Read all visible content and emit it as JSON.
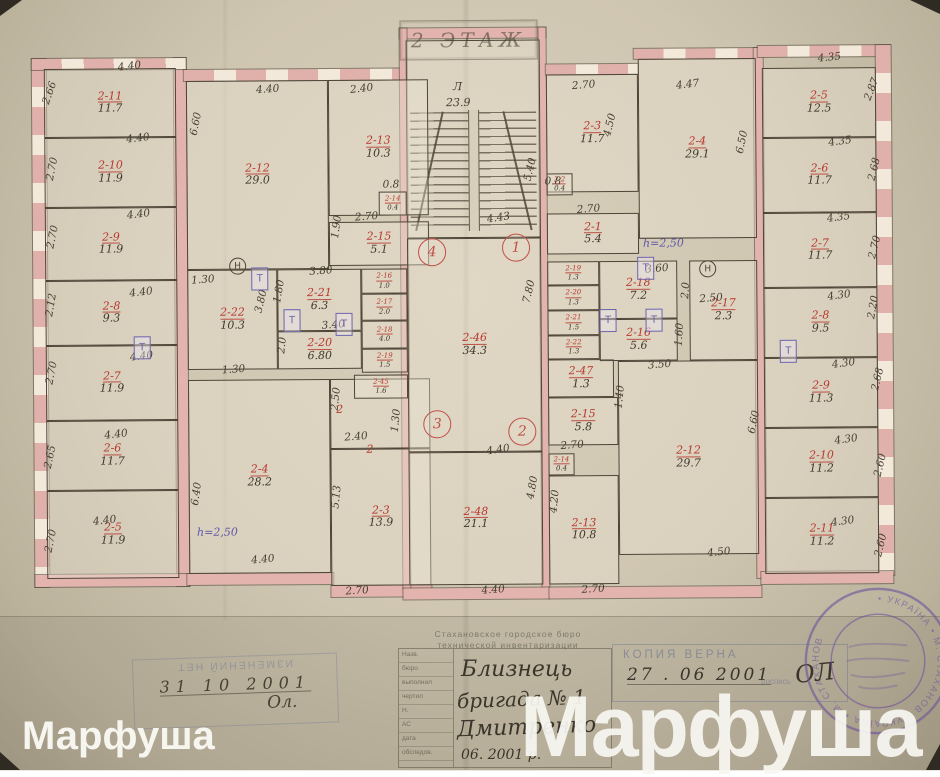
{
  "title": {
    "floor_label": "2 ЭТАЖ"
  },
  "colors": {
    "paper": "#d8cfba",
    "wall_pink": "#e2b4ad",
    "ink_red": "#b8382f",
    "ink_dark": "#463f33",
    "ink_blue": "#5d58aa",
    "stamp_blue": "#6771a0",
    "seal_purple": "#6b4f9e"
  },
  "plan": {
    "rooms": [
      {
        "id": "2-11",
        "area": "11.7",
        "x": 46,
        "y": 66,
        "w": 132,
        "h": 69
      },
      {
        "id": "2-10",
        "area": "11.9",
        "x": 46,
        "y": 135,
        "w": 132,
        "h": 70
      },
      {
        "id": "2-9",
        "area": "11.9",
        "x": 46,
        "y": 205,
        "w": 132,
        "h": 73
      },
      {
        "id": "2-8",
        "area": "9.3",
        "x": 46,
        "y": 278,
        "w": 132,
        "h": 65
      },
      {
        "id": "2-7",
        "area": "11.9",
        "x": 46,
        "y": 343,
        "w": 132,
        "h": 75
      },
      {
        "id": "2-6",
        "area": "11.7",
        "x": 46,
        "y": 418,
        "w": 132,
        "h": 70
      },
      {
        "id": "2-5",
        "area": "11.9",
        "x": 46,
        "y": 488,
        "w": 132,
        "h": 88
      },
      {
        "id": "2-12",
        "area": "29.0",
        "x": 188,
        "y": 79,
        "w": 142,
        "h": 189
      },
      {
        "id": "2-13",
        "area": "10.3",
        "x": 330,
        "y": 79,
        "w": 100,
        "h": 136
      },
      {
        "id": "2-14",
        "area": "0.4",
        "x": 380,
        "y": 191,
        "w": 28,
        "h": 24
      },
      {
        "id": "2-15",
        "area": "5.1",
        "x": 330,
        "y": 221,
        "w": 100,
        "h": 44
      },
      {
        "id": "2-22",
        "area": "10.3",
        "x": 188,
        "y": 268,
        "w": 90,
        "h": 100
      },
      {
        "id": "2-21",
        "area": "6.3",
        "x": 278,
        "y": 268,
        "w": 84,
        "h": 62
      },
      {
        "id": "2-20",
        "area": "6.80",
        "x": 278,
        "y": 330,
        "w": 84,
        "h": 38
      },
      {
        "id": "2-16",
        "area": "1.0",
        "x": 362,
        "y": 268,
        "w": 46,
        "h": 25
      },
      {
        "id": "2-17",
        "area": "2.0",
        "x": 362,
        "y": 293,
        "w": 46,
        "h": 27
      },
      {
        "id": "2-18",
        "area": "4.0",
        "x": 362,
        "y": 320,
        "w": 46,
        "h": 28
      },
      {
        "id": "2-19",
        "area": "1.5",
        "x": 362,
        "y": 348,
        "w": 46,
        "h": 24
      },
      {
        "id": "2-45",
        "area": "1.6",
        "x": 354,
        "y": 374,
        "w": 54,
        "h": 24
      },
      {
        "id": "2-4",
        "area": "28.2",
        "x": 188,
        "y": 378,
        "w": 142,
        "h": 194
      },
      {
        "id": "2-3",
        "area": "13.9",
        "x": 330,
        "y": 448,
        "w": 100,
        "h": 137
      },
      {
        "id": "2-46",
        "area": "34.3",
        "x": 408,
        "y": 238,
        "w": 134,
        "h": 214
      },
      {
        "id": "2-48",
        "area": "21.1",
        "x": 408,
        "y": 452,
        "w": 134,
        "h": 133
      },
      {
        "id": "2-3",
        "area": "11.7",
        "x": 548,
        "y": 75,
        "w": 92,
        "h": 118
      },
      {
        "id": "2-4",
        "area": "29.1",
        "x": 640,
        "y": 60,
        "w": 118,
        "h": 180
      },
      {
        "id": "2-2",
        "area": "0.4",
        "x": 548,
        "y": 174,
        "w": 26,
        "h": 22
      },
      {
        "id": "2-1",
        "area": "5.4",
        "x": 548,
        "y": 214,
        "w": 92,
        "h": 41
      },
      {
        "id": "2-19",
        "area": "1.3",
        "x": 548,
        "y": 262,
        "w": 52,
        "h": 24
      },
      {
        "id": "2-20",
        "area": "1.3",
        "x": 548,
        "y": 286,
        "w": 52,
        "h": 25
      },
      {
        "id": "2-21",
        "area": "1.5",
        "x": 548,
        "y": 311,
        "w": 52,
        "h": 25
      },
      {
        "id": "2-22",
        "area": "1.3",
        "x": 548,
        "y": 336,
        "w": 52,
        "h": 24
      },
      {
        "id": "2-47",
        "area": "1.3",
        "x": 548,
        "y": 360,
        "w": 66,
        "h": 38
      },
      {
        "id": "2-18",
        "area": "7.2",
        "x": 600,
        "y": 262,
        "w": 78,
        "h": 58
      },
      {
        "id": "2-16",
        "area": "5.6",
        "x": 600,
        "y": 320,
        "w": 78,
        "h": 42
      },
      {
        "id": "2-17",
        "area": "2.3",
        "x": 690,
        "y": 262,
        "w": 68,
        "h": 100
      },
      {
        "id": "2-15",
        "area": "5.8",
        "x": 548,
        "y": 398,
        "w": 70,
        "h": 48
      },
      {
        "id": "2-14",
        "area": "0.4",
        "x": 548,
        "y": 454,
        "w": 26,
        "h": 22
      },
      {
        "id": "2-13",
        "area": "10.8",
        "x": 548,
        "y": 476,
        "w": 70,
        "h": 109
      },
      {
        "id": "2-12",
        "area": "29.7",
        "x": 618,
        "y": 362,
        "w": 140,
        "h": 194
      },
      {
        "id": "2-5",
        "area": "12.5",
        "x": 764,
        "y": 70,
        "w": 114,
        "h": 70
      },
      {
        "id": "2-6",
        "area": "11.7",
        "x": 764,
        "y": 140,
        "w": 114,
        "h": 75
      },
      {
        "id": "2-7",
        "area": "11.7",
        "x": 764,
        "y": 215,
        "w": 114,
        "h": 75
      },
      {
        "id": "2-8",
        "area": "9.5",
        "x": 764,
        "y": 290,
        "w": 114,
        "h": 70
      },
      {
        "id": "2-9",
        "area": "11.3",
        "x": 764,
        "y": 360,
        "w": 114,
        "h": 70
      },
      {
        "id": "2-10",
        "area": "11.2",
        "x": 764,
        "y": 430,
        "w": 114,
        "h": 70
      },
      {
        "id": "2-11",
        "area": "11.2",
        "x": 764,
        "y": 500,
        "w": 114,
        "h": 76
      }
    ],
    "dims": [
      {
        "t": "2.66",
        "x": 40,
        "y": 84,
        "r": -70
      },
      {
        "t": "2.70",
        "x": 42,
        "y": 160,
        "r": -78
      },
      {
        "t": "2.70",
        "x": 42,
        "y": 228,
        "r": -78
      },
      {
        "t": "2.12",
        "x": 40,
        "y": 296,
        "r": -80
      },
      {
        "t": "2.70",
        "x": 40,
        "y": 364,
        "r": -78
      },
      {
        "t": "2.65",
        "x": 38,
        "y": 448,
        "r": -78
      },
      {
        "t": "2.70",
        "x": 38,
        "y": 532,
        "r": -78
      },
      {
        "t": "4.40",
        "x": 120,
        "y": 58,
        "r": -6
      },
      {
        "t": "4.40",
        "x": 128,
        "y": 130,
        "r": -6
      },
      {
        "t": "4.40",
        "x": 128,
        "y": 206,
        "r": -6
      },
      {
        "t": "4.40",
        "x": 130,
        "y": 284,
        "r": -6
      },
      {
        "t": "4.40",
        "x": 130,
        "y": 348,
        "r": -6
      },
      {
        "t": "4.40",
        "x": 104,
        "y": 426,
        "r": -6
      },
      {
        "t": "4.40",
        "x": 92,
        "y": 512,
        "r": -6
      },
      {
        "t": "6.60",
        "x": 186,
        "y": 116,
        "r": -78
      },
      {
        "t": "1.30",
        "x": 192,
        "y": 272,
        "r": -4
      },
      {
        "t": "6.40",
        "x": 184,
        "y": 486,
        "r": -82
      },
      {
        "t": "4.40",
        "x": 258,
        "y": 82,
        "r": -4
      },
      {
        "t": "2.40",
        "x": 352,
        "y": 82,
        "r": -6
      },
      {
        "t": "0.8",
        "x": 384,
        "y": 178,
        "r": 0
      },
      {
        "t": "2.70",
        "x": 356,
        "y": 210,
        "r": -4
      },
      {
        "t": "1.90",
        "x": 326,
        "y": 220,
        "r": -82
      },
      {
        "t": "3.80",
        "x": 310,
        "y": 264,
        "r": -4
      },
      {
        "t": "1.80",
        "x": 268,
        "y": 284,
        "r": -80
      },
      {
        "t": "3.80",
        "x": 250,
        "y": 294,
        "r": -76
      },
      {
        "t": "3.40",
        "x": 322,
        "y": 318,
        "r": -4
      },
      {
        "t": "2.0",
        "x": 274,
        "y": 338,
        "r": -84
      },
      {
        "t": "1.30",
        "x": 222,
        "y": 362,
        "r": -4
      },
      {
        "t": "2.50",
        "x": 324,
        "y": 392,
        "r": -84
      },
      {
        "t": "1.30",
        "x": 384,
        "y": 414,
        "r": -84
      },
      {
        "t": "2.40",
        "x": 344,
        "y": 430,
        "r": -4
      },
      {
        "t": "5.13",
        "x": 324,
        "y": 490,
        "r": -84
      },
      {
        "t": "4.40",
        "x": 250,
        "y": 552,
        "r": -5
      },
      {
        "t": "2.70",
        "x": 344,
        "y": 584,
        "r": -3
      },
      {
        "t": "5.40",
        "x": 520,
        "y": 164,
        "r": -76
      },
      {
        "t": "4.43",
        "x": 488,
        "y": 212,
        "r": -8
      },
      {
        "t": "7.80",
        "x": 518,
        "y": 286,
        "r": -76
      },
      {
        "t": "4.40",
        "x": 486,
        "y": 444,
        "r": -8
      },
      {
        "t": "4.80",
        "x": 520,
        "y": 482,
        "r": -80
      },
      {
        "t": "4.40",
        "x": 480,
        "y": 584,
        "r": -4
      },
      {
        "t": "2.70",
        "x": 574,
        "y": 80,
        "r": -4
      },
      {
        "t": "4.47",
        "x": 678,
        "y": 80,
        "r": -6
      },
      {
        "t": "4.50",
        "x": 600,
        "y": 120,
        "r": -76
      },
      {
        "t": "6.50",
        "x": 732,
        "y": 138,
        "r": -78
      },
      {
        "t": "0.8",
        "x": 546,
        "y": 176,
        "r": 0
      },
      {
        "t": "2.70",
        "x": 578,
        "y": 204,
        "r": -4
      },
      {
        "t": "3.60",
        "x": 646,
        "y": 264,
        "r": -4
      },
      {
        "t": "2.0",
        "x": 678,
        "y": 286,
        "r": -86
      },
      {
        "t": "2.50",
        "x": 700,
        "y": 294,
        "r": -4
      },
      {
        "t": "1.60",
        "x": 668,
        "y": 330,
        "r": -86
      },
      {
        "t": "3.50",
        "x": 648,
        "y": 360,
        "r": -4
      },
      {
        "t": "1.40",
        "x": 608,
        "y": 392,
        "r": -84
      },
      {
        "t": "2.70",
        "x": 560,
        "y": 440,
        "r": -4
      },
      {
        "t": "4.20",
        "x": 542,
        "y": 496,
        "r": -84
      },
      {
        "t": "6.60",
        "x": 742,
        "y": 418,
        "r": -78
      },
      {
        "t": "4.50",
        "x": 706,
        "y": 548,
        "r": -5
      },
      {
        "t": "2.70",
        "x": 580,
        "y": 584,
        "r": -3
      },
      {
        "t": "4.35",
        "x": 820,
        "y": 54,
        "r": -5
      },
      {
        "t": "4.35",
        "x": 830,
        "y": 138,
        "r": -7
      },
      {
        "t": "4.35",
        "x": 828,
        "y": 214,
        "r": -7
      },
      {
        "t": "4.30",
        "x": 828,
        "y": 292,
        "r": -7
      },
      {
        "t": "4.30",
        "x": 832,
        "y": 360,
        "r": -7
      },
      {
        "t": "4.30",
        "x": 834,
        "y": 436,
        "r": -7
      },
      {
        "t": "4.30",
        "x": 830,
        "y": 518,
        "r": -7
      },
      {
        "t": "2.87",
        "x": 862,
        "y": 86,
        "r": -68
      },
      {
        "t": "2.68",
        "x": 864,
        "y": 166,
        "r": -76
      },
      {
        "t": "2.70",
        "x": 864,
        "y": 244,
        "r": -76
      },
      {
        "t": "2.20",
        "x": 862,
        "y": 304,
        "r": -80
      },
      {
        "t": "2.68",
        "x": 866,
        "y": 376,
        "r": -76
      },
      {
        "t": "2.60",
        "x": 868,
        "y": 462,
        "r": -76
      },
      {
        "t": "2.60",
        "x": 868,
        "y": 542,
        "r": -76
      }
    ],
    "axes": [
      {
        "n": "4",
        "x": 419,
        "y": 238
      },
      {
        "n": "1",
        "x": 503,
        "y": 234
      },
      {
        "n": "3",
        "x": 423,
        "y": 410
      },
      {
        "n": "2",
        "x": 508,
        "y": 418
      }
    ],
    "notes": [
      {
        "t": "Л",
        "x": 455,
        "y": 80,
        "cls": "dark"
      },
      {
        "t": "23.9",
        "x": 448,
        "y": 96,
        "cls": "dark"
      },
      {
        "t": "h=2,50",
        "x": 196,
        "y": 524,
        "cls": "blue"
      },
      {
        "t": "h=2,50",
        "x": 644,
        "y": 238,
        "cls": "blue"
      },
      {
        "t": "2",
        "x": 336,
        "y": 402,
        "cls": "red"
      },
      {
        "t": "2",
        "x": 366,
        "y": 442,
        "cls": "red"
      }
    ],
    "symbols": {
      "t_glyph": "Т",
      "h_glyph": "Н",
      "t_boxes": [
        {
          "x": 252,
          "y": 266
        },
        {
          "x": 284,
          "y": 308
        },
        {
          "x": 336,
          "y": 312
        },
        {
          "x": 134,
          "y": 334
        },
        {
          "x": 600,
          "y": 310
        },
        {
          "x": 646,
          "y": 310
        },
        {
          "x": 638,
          "y": 258
        },
        {
          "x": 780,
          "y": 342
        }
      ],
      "h_circles": [
        {
          "x": 230,
          "y": 256
        },
        {
          "x": 700,
          "y": 262
        }
      ]
    }
  },
  "stamps": {
    "left": {
      "printed": "ИЗМЕНЕНИЙ НЕТ",
      "date": "31  10  2001",
      "sig": "Ол."
    },
    "center": {
      "org_line1": "Стахановское городское бюро",
      "org_line2": "технической инвентаризации",
      "rows": [
        "Назв.",
        "бюро",
        "выполнил",
        "чертил",
        "Н.",
        "АС",
        "дата",
        "обследов."
      ],
      "hand1": "Близнець",
      "hand2": "бригада № 1",
      "hand3": "Дмитренко",
      "hand4": "06. 2001 р."
    },
    "right": {
      "printed": "КОПИЯ ВЕРНА",
      "date": "27 .  06  2001",
      "note": "роспись",
      "sig": "ОЛ"
    },
    "seal": {
      "ring_text": "• УКРАЇНА • М. СТАХАНОВ • УКРАЇНА • М. СТАХАНОВ"
    }
  },
  "watermarks": {
    "small": "Марфуша",
    "large": "Марфуша"
  }
}
